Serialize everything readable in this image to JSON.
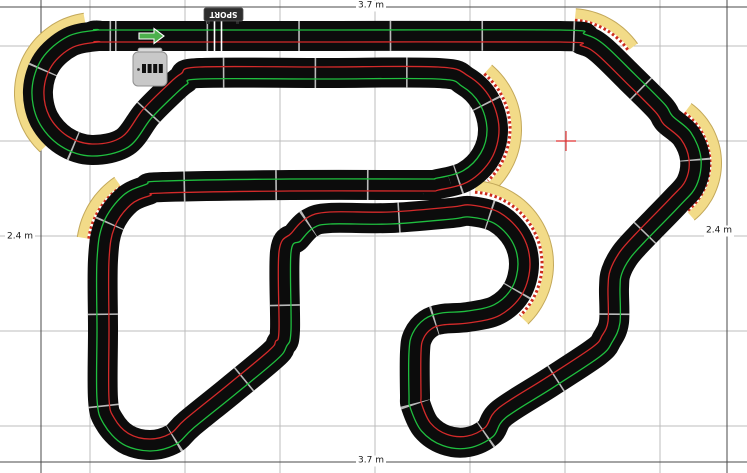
{
  "canvas": {
    "width": 747,
    "height": 473,
    "background": "#ffffff"
  },
  "grid": {
    "color": "#bcbcbc",
    "vertical_lines": [
      90,
      185,
      280,
      375,
      470,
      565,
      660
    ],
    "horizontal_lines": [
      46,
      141,
      236,
      331,
      426
    ]
  },
  "dimensions": {
    "line_color": "#4a4a4a",
    "top": {
      "label": "3.7 m",
      "line_y": 7,
      "label_x": 371,
      "label_y": 6
    },
    "bottom": {
      "label": "3.7 m",
      "line_y": 462,
      "label_x": 371,
      "label_y": 461
    },
    "left": {
      "label": "2.4 m",
      "line_x": 41,
      "label_x": 20,
      "label_y": 237
    },
    "right": {
      "label": "2.4 m",
      "line_x": 727,
      "label_x": 719,
      "label_y": 231
    }
  },
  "track": {
    "surface_color": "#0c0c0c",
    "width": 30,
    "joint_color": "#d9d9d9",
    "joint_dash": [
      1.6,
      90
    ],
    "lanes": [
      {
        "name": "green-lane",
        "color": "#1fbf3f",
        "offset": -6,
        "width": 1.3
      },
      {
        "name": "red-lane",
        "color": "#d42a2a",
        "offset": 6,
        "width": 1.3
      }
    ],
    "centerline": [
      [
        115,
        36
      ],
      [
        340,
        36
      ],
      [
        560,
        36
      ],
      [
        583,
        40
      ],
      [
        600,
        49
      ],
      [
        630,
        78
      ],
      [
        660,
        108
      ],
      [
        668,
        120
      ],
      [
        686,
        136
      ],
      [
        695,
        159
      ],
      [
        691,
        183
      ],
      [
        675,
        202
      ],
      [
        640,
        238
      ],
      [
        625,
        255
      ],
      [
        616,
        272
      ],
      [
        614,
        288
      ],
      [
        614,
        322
      ],
      [
        607,
        339
      ],
      [
        596,
        352
      ],
      [
        549,
        383
      ],
      [
        502,
        413
      ],
      [
        489,
        432
      ],
      [
        468,
        442
      ],
      [
        445,
        440
      ],
      [
        426,
        427
      ],
      [
        416,
        406
      ],
      [
        415,
        395
      ],
      [
        415,
        352
      ],
      [
        418,
        336
      ],
      [
        428,
        324
      ],
      [
        442,
        319
      ],
      [
        468,
        317
      ],
      [
        497,
        310
      ],
      [
        517,
        291
      ],
      [
        524,
        264
      ],
      [
        517,
        238
      ],
      [
        497,
        218
      ],
      [
        470,
        211
      ],
      [
        452,
        213
      ],
      [
        390,
        218
      ],
      [
        330,
        218
      ],
      [
        310,
        223
      ],
      [
        296,
        237
      ],
      [
        285,
        252
      ],
      [
        285,
        330
      ],
      [
        281,
        344
      ],
      [
        273,
        355
      ],
      [
        231,
        390
      ],
      [
        189,
        424
      ],
      [
        173,
        439
      ],
      [
        150,
        445
      ],
      [
        126,
        439
      ],
      [
        109,
        421
      ],
      [
        103,
        399
      ],
      [
        103,
        330
      ],
      [
        103,
        260
      ],
      [
        109,
        225
      ],
      [
        127,
        200
      ],
      [
        148,
        190
      ],
      [
        163,
        187
      ],
      [
        290,
        185
      ],
      [
        420,
        185
      ],
      [
        438,
        184
      ],
      [
        466,
        176
      ],
      [
        486,
        156
      ],
      [
        493,
        129
      ],
      [
        485,
        101
      ],
      [
        465,
        81
      ],
      [
        438,
        73
      ],
      [
        320,
        73
      ],
      [
        200,
        73
      ],
      [
        184,
        79
      ],
      [
        170,
        91
      ],
      [
        147,
        114
      ],
      [
        125,
        142
      ],
      [
        92,
        150
      ],
      [
        64,
        141
      ],
      [
        44,
        119
      ],
      [
        38,
        90
      ],
      [
        47,
        62
      ],
      [
        70,
        42
      ],
      [
        98,
        36
      ]
    ]
  },
  "borders": {
    "fill": "#f2db88",
    "edge": "#c3a85a",
    "curb_white": "#ffffff",
    "curb_red": "#cc2b1d",
    "band_width": 13,
    "arcs": [
      {
        "name": "top-left-hairpin-border",
        "cx": 95,
        "cy": 93,
        "r": 74,
        "a0": 133,
        "a1": 264
      },
      {
        "name": "left-mid-curve-border",
        "cx": 163,
        "cy": 249,
        "r": 80,
        "a0": 188,
        "a1": 237
      },
      {
        "name": "upper-hairpin-border",
        "cx": 438,
        "cy": 129,
        "r": 77,
        "a0": -50,
        "a1": 47
      },
      {
        "name": "mid-hairpin-border",
        "cx": 470,
        "cy": 264,
        "r": 77,
        "a0": -86,
        "a1": 46
      },
      {
        "name": "top-right-curve-border",
        "cx": 570,
        "cy": 91,
        "r": 76,
        "a0": -86,
        "a1": -33
      },
      {
        "name": "right-mid-curve-border",
        "cx": 648,
        "cy": 163,
        "r": 67,
        "a0": -54,
        "a1": 53
      }
    ]
  },
  "start": {
    "start_line": {
      "xs": [
        214.5,
        221.5
      ],
      "y0": 21,
      "y1": 51,
      "color": "#ffffff",
      "width": 1.6
    },
    "sign": {
      "label": "SPORT",
      "x": 204,
      "y": 8,
      "w": 39,
      "h": 13,
      "fill": "#2d2d2d",
      "stroke": "#555555",
      "text_color": "#ffffff"
    },
    "arrow": {
      "color": "#4db04d",
      "outline": "#ffffff",
      "points": "139,33 154,33 154,28.5 164,36 154,43.5 154,39 139,39"
    },
    "powerbase": {
      "x": 133,
      "y": 52,
      "w": 34,
      "h": 34,
      "fill": "#c8c8c8",
      "stroke": "#909090",
      "flap_fill": "#d8d8d8",
      "connector_color": "#101010",
      "dot_color": "#333333"
    }
  },
  "crosshair": {
    "x": 566,
    "y": 141,
    "arm": 10,
    "color": "#e03030"
  }
}
